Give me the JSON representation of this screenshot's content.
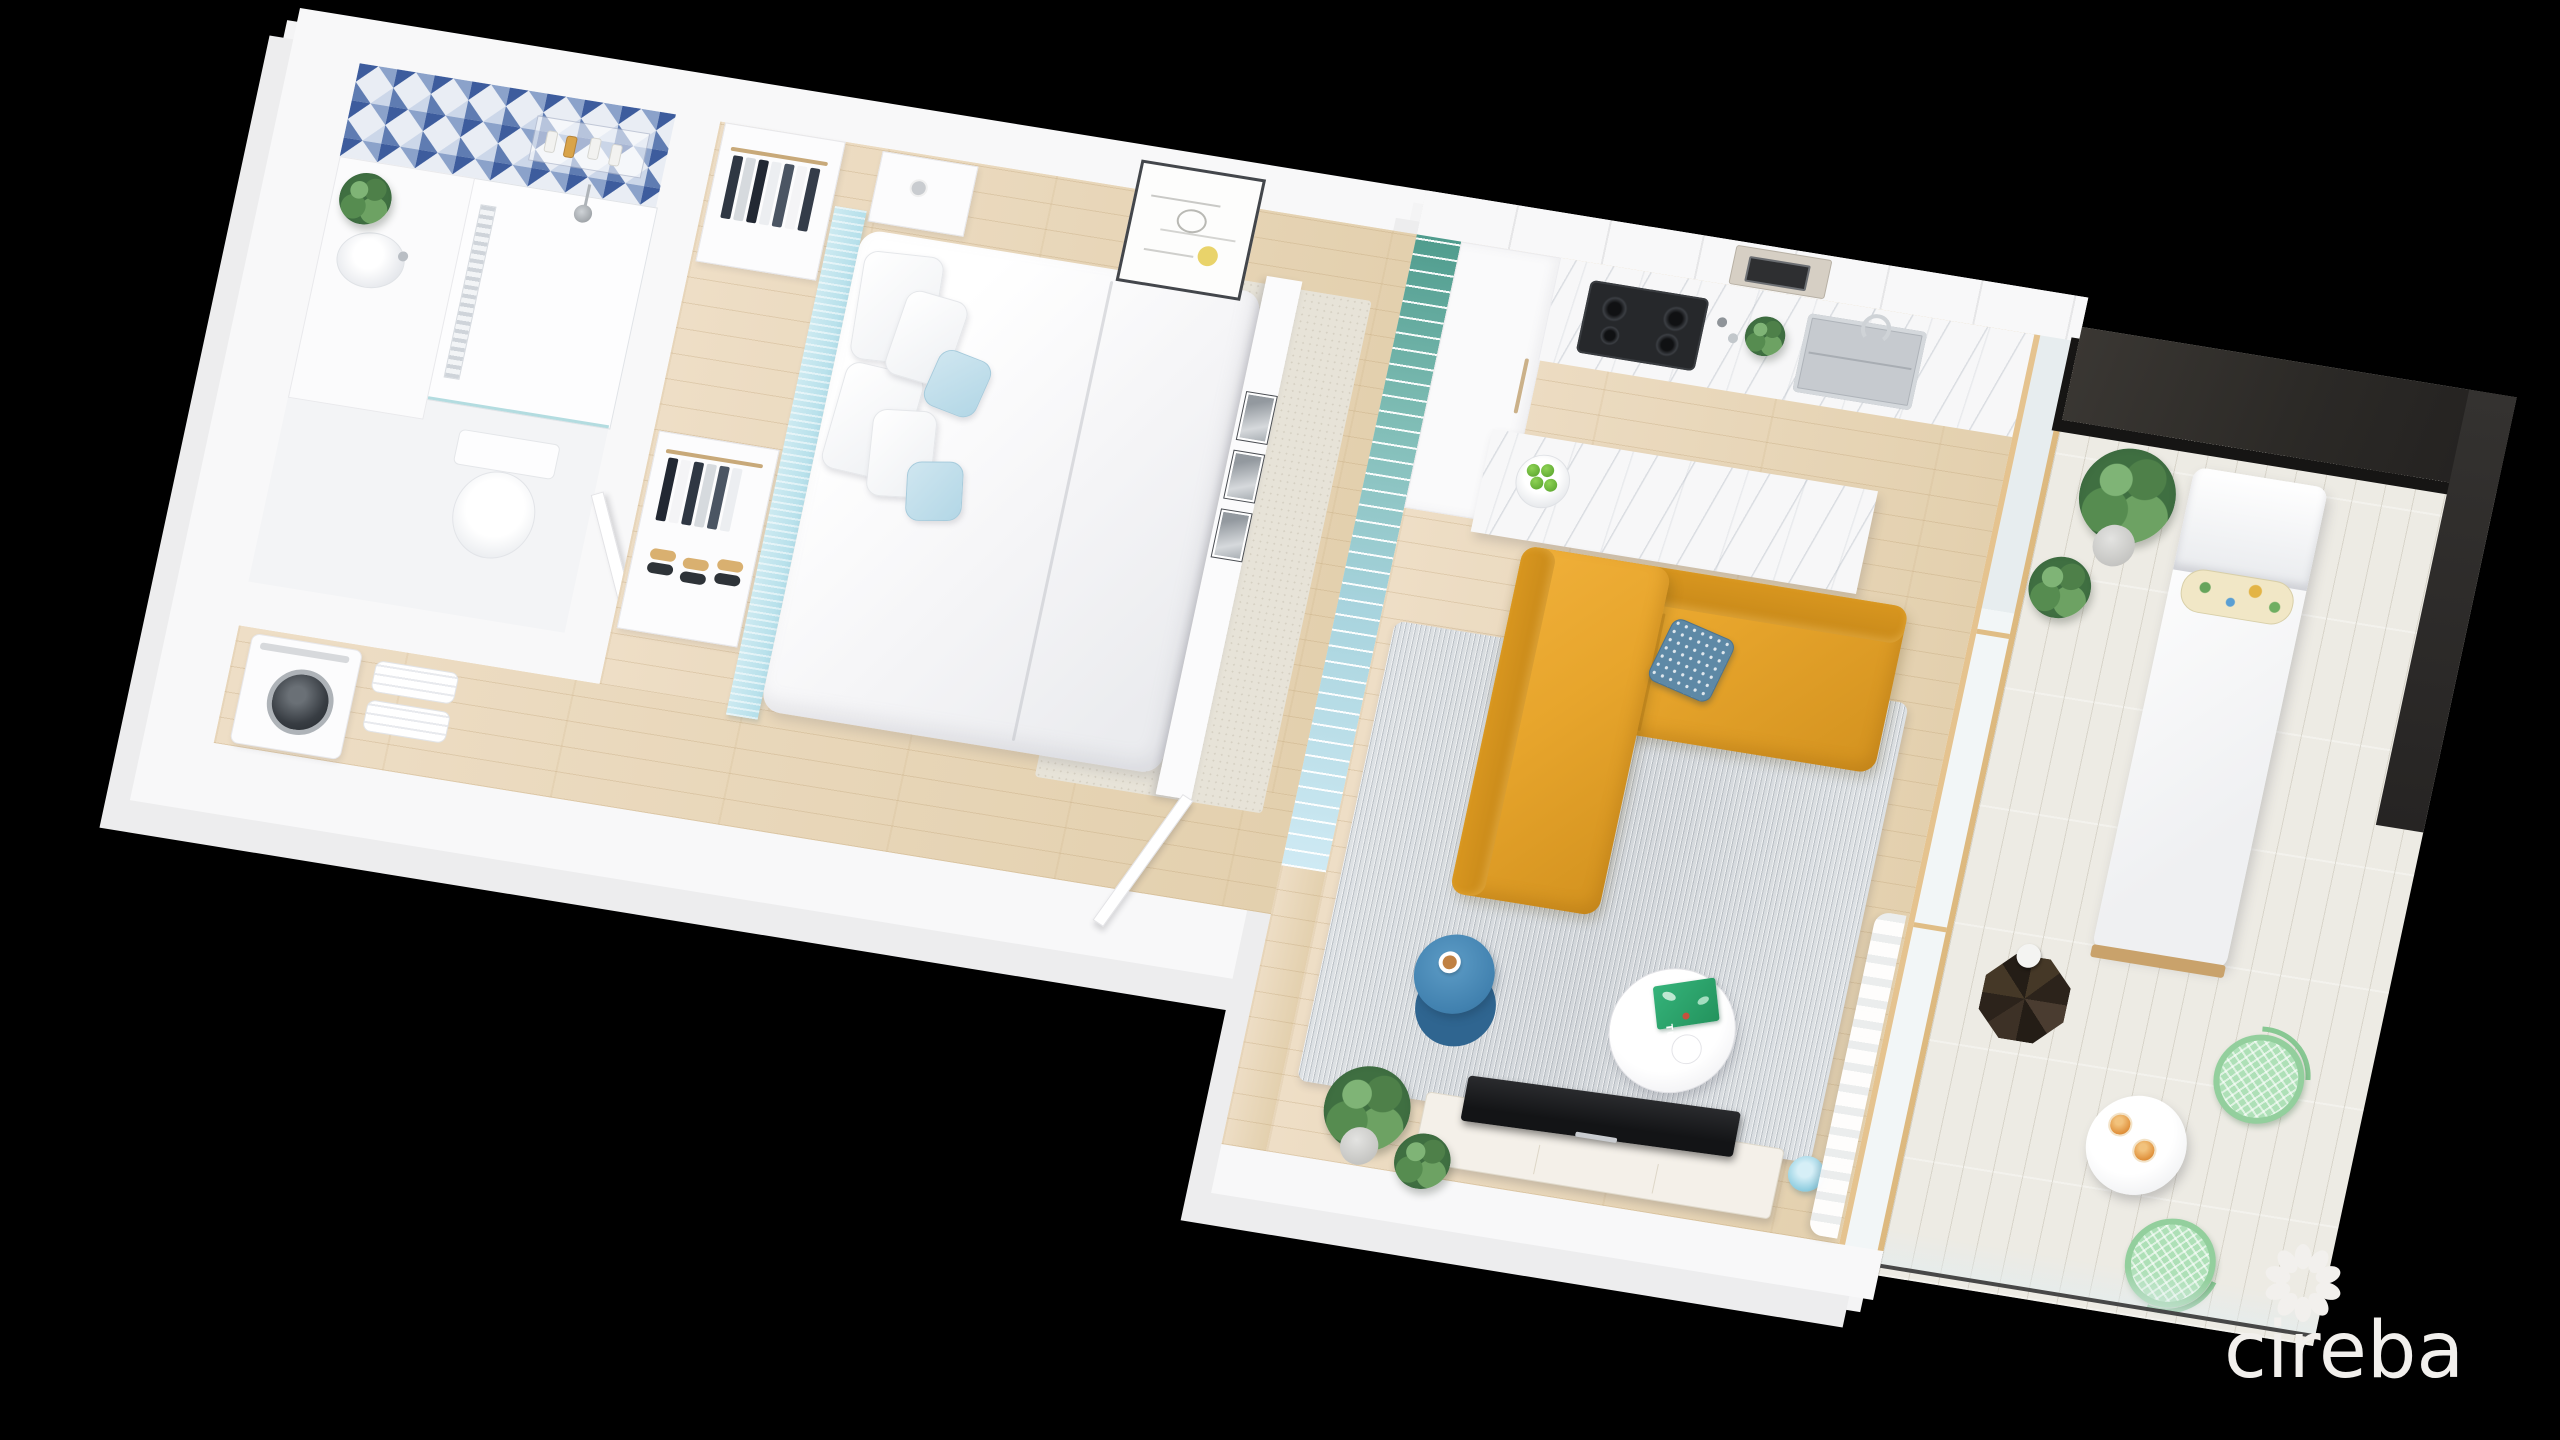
{
  "watermark": {
    "brand": "cireba",
    "icon": "flower-logo-icon",
    "color": "#f2f0ed"
  },
  "scene": {
    "type": "3d-isometric-floor-plan-render",
    "background_color": "#000000",
    "book_title": "TULUM",
    "divider": "teal-gradient-vertical-fin-screen",
    "rooms": [
      {
        "name": "bathroom",
        "features": [
          "blue-triangle-mosaic-shower-wall",
          "walk-in-shower",
          "rain-shower-head",
          "shower-niche-with-bottles",
          "glass-partition",
          "vanity-with-round-basin",
          "potted-plant",
          "toilet",
          "open-door"
        ]
      },
      {
        "name": "laundry-nook",
        "features": [
          "washing-machine",
          "folded-towel-shelves"
        ]
      },
      {
        "name": "bedroom",
        "features": [
          "double-bed-white-linen",
          "light-blue-headboard-wall",
          "two-open-wardrobes-with-clothes",
          "shoe-shelf",
          "nightstand-shelf",
          "framed-line-art-with-yellow-dot",
          "partition-wall-three-bw-photos",
          "beige-area-rug",
          "open-door"
        ]
      },
      {
        "name": "kitchen",
        "features": [
          "white-flat-front-cabinets",
          "built-in-microwave",
          "tall-pantry-cabinet",
          "marble-counter",
          "black-gas-cooktop",
          "salt-pepper-grinders",
          "herb-plant",
          "stainless-sink-with-faucet",
          "marble-island",
          "bowl-of-limes"
        ]
      },
      {
        "name": "living-room",
        "features": [
          "gray-melange-rug",
          "mustard-l-shaped-sofa",
          "patterned-blue-cushion",
          "blue-round-side-table",
          "coffee-cup",
          "white-round-coffee-table",
          "green-travel-book",
          "glass-vase",
          "tv-on-white-console",
          "blue-table-lamp",
          "two-potted-plants",
          "sheer-curtain",
          "wood-framed-sliding-glass-door"
        ]
      },
      {
        "name": "balcony",
        "features": [
          "dark-charcoal-feature-wall",
          "whitewashed-plank-deck",
          "white-chaise-lounge",
          "tropical-print-bolster",
          "dark-geometric-side-table",
          "white-vase",
          "two-potted-plants",
          "white-pedestal-bistro-table",
          "two-orange-juice-glasses",
          "two-mint-wire-chairs",
          "glass-railing"
        ]
      }
    ],
    "palette": {
      "tile_navy": "#3d5c9d",
      "tile_light": "#ccd7e9",
      "headboard_blue": "#b9e1ec",
      "fin_teal": "#4f9c8d",
      "fin_pale": "#cfeaf4",
      "sofa_mustard": "#e7a52c",
      "side_table_blue": "#4181af",
      "lamp_blue": "#8fcde0",
      "mint_chair": "#aee0b7",
      "juice_orange": "#e0913c",
      "book_green": "#23935d",
      "wood_floor": "#e9d8bb",
      "deck": "#edebe4",
      "dark_wall": "#2b2926",
      "walls": "#f8f8f9"
    }
  }
}
